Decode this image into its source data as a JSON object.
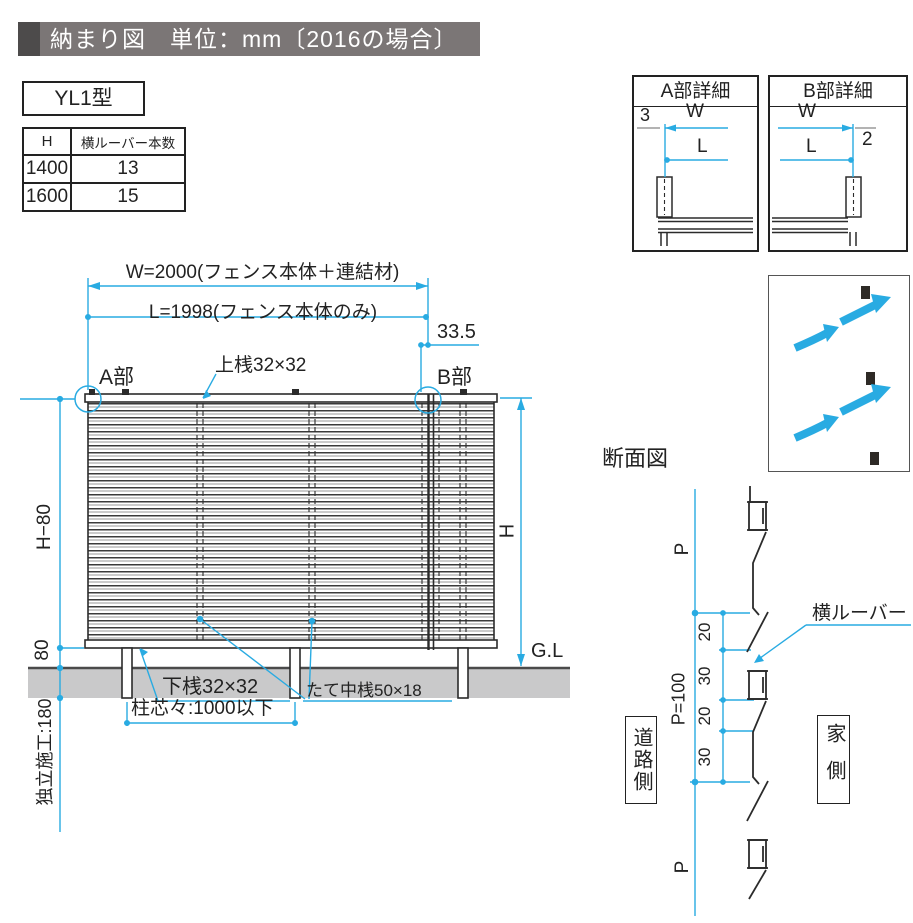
{
  "title": {
    "text": "納まり図　単位：mm〔2016の場合〕"
  },
  "model": {
    "label": "YL1型"
  },
  "spec_table": {
    "headers": [
      "H",
      "横ルーバー本数"
    ],
    "rows": [
      [
        "1400",
        "13"
      ],
      [
        "1600",
        "15"
      ]
    ]
  },
  "main_drawing": {
    "dim_w": "W=2000(フェンス本体＋連結材)",
    "dim_l": "L=1998(フェンス本体のみ)",
    "dim_offset": "33.5",
    "label_a": "A部",
    "label_b": "B部",
    "top_rail": "上桟32×32",
    "bottom_rail": "下桟32×32",
    "vertical_rail": "たて中桟50×18",
    "post_pitch": "柱芯々:1000以下",
    "dim_h_minus_80": "H−80",
    "dim_80": "80",
    "dim_foundation": "独立施工:180",
    "dim_h": "H",
    "ground_level": "G.L"
  },
  "detail_a": {
    "title": "A部詳細",
    "dim_3": "3",
    "dim_w": "W",
    "dim_l": "L"
  },
  "detail_b": {
    "title": "B部詳細",
    "dim_w": "W",
    "dim_l": "L",
    "dim_2": "2"
  },
  "section": {
    "title": "断面図",
    "dim_p_top": "P",
    "dim_p_bottom": "P",
    "dim_p100": "P=100",
    "dims": [
      "20",
      "30",
      "20",
      "30"
    ],
    "louver_label": "横ルーバー",
    "road_side": "道路側",
    "house_side": "家側"
  },
  "colors": {
    "dimension": "#29abe2",
    "ground": "#c9c9ca",
    "title_bar": "#7b7676",
    "title_square": "#4d4b4b"
  }
}
